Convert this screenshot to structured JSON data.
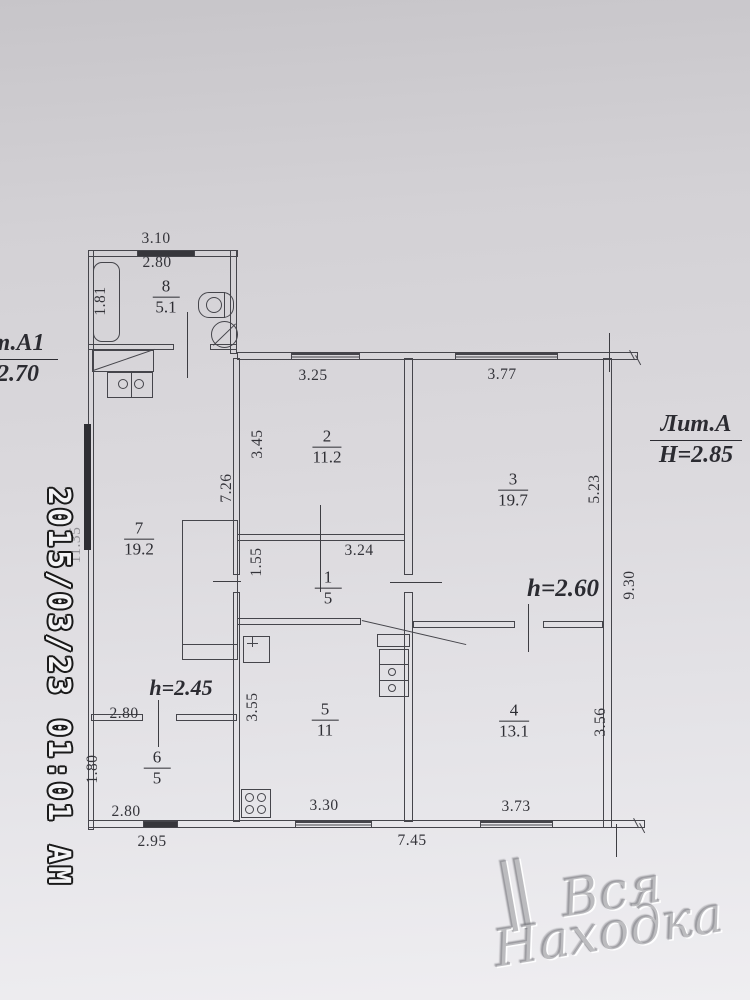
{
  "labels": {
    "lit_a": {
      "title": "Лит.А",
      "height": "Н=2.85"
    },
    "lit_a1": {
      "title": "т.А1",
      "height": "2.70"
    },
    "h_main": "h=2.60",
    "h_porch": "h=2.45"
  },
  "rooms": [
    {
      "number": "8",
      "area": "5.1"
    },
    {
      "number": "2",
      "area": "11.2"
    },
    {
      "number": "3",
      "area": "19.7"
    },
    {
      "number": "7",
      "area": "19.2"
    },
    {
      "number": "1",
      "area": "5"
    },
    {
      "number": "5",
      "area": "11"
    },
    {
      "number": "4",
      "area": "13.1"
    },
    {
      "number": "6",
      "area": "5"
    }
  ],
  "dimensions": [
    "3.10",
    "2.80",
    "1.81",
    "3.25",
    "3.45",
    "3.77",
    "5.23",
    "9.30",
    "7.26",
    "1.55",
    "3.24",
    "2.80",
    "1.80",
    "2.80",
    "2.95",
    "3.55",
    "3.30",
    "7.45",
    "3.56",
    "3.73",
    "11.35"
  ],
  "watermarks": {
    "timestamp": "2015/03/23 01:01 AM",
    "site_mark": "∥",
    "site_line1": "Вся",
    "site_line2": "Находка"
  }
}
